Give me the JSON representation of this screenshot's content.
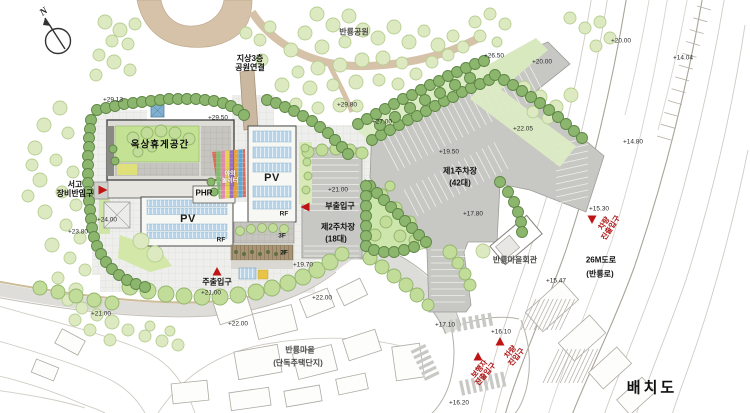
{
  "drawing_title": "배치도",
  "compass": {
    "label": "N"
  },
  "colors": {
    "marker_red": "#c01414",
    "lawn_green": "#cde6ab",
    "hedge_green": "#8cb66d",
    "parking_gray": "#c7c7c4",
    "pv_panel_blue": "#b7d3e7",
    "path_tan": "#d6c2a8"
  },
  "places": [
    {
      "id": "banryong-park",
      "text": "반룡공원",
      "x": 354,
      "y": 33,
      "cls": "place"
    },
    {
      "id": "park-connection",
      "text": "지상3층\n공원연결",
      "x": 250,
      "y": 64,
      "cls": "bold-k"
    },
    {
      "id": "rooftop-rest-space",
      "text": "옥상휴게공간",
      "x": 160,
      "y": 146,
      "cls": "bold-k big"
    },
    {
      "id": "outdoor-playground",
      "text": "야외\n놀이터",
      "x": 230,
      "y": 178,
      "cls": "white-k"
    },
    {
      "id": "phr",
      "text": "PHR",
      "x": 204,
      "y": 194,
      "cls": "bold-k"
    },
    {
      "id": "pv-upper",
      "text": "PV",
      "x": 272,
      "y": 178,
      "cls": "pv"
    },
    {
      "id": "rf-upper",
      "text": "RF",
      "x": 284,
      "y": 214,
      "cls": "rf"
    },
    {
      "id": "pv-lower",
      "text": "PV",
      "x": 188,
      "y": 219,
      "cls": "pv"
    },
    {
      "id": "rf-lower",
      "text": "RF",
      "x": 221,
      "y": 240,
      "cls": "rf"
    },
    {
      "id": "floor-3f",
      "text": "3F",
      "x": 282,
      "y": 236,
      "cls": "rf"
    },
    {
      "id": "floor-2f",
      "text": "2F",
      "x": 284,
      "y": 253,
      "cls": "rf"
    },
    {
      "id": "parking1-name",
      "text": "제1주차장",
      "x": 460,
      "y": 172,
      "cls": "bold-k"
    },
    {
      "id": "parking1-capacity",
      "text": "(42대)",
      "x": 460,
      "y": 184,
      "cls": "bold-k"
    },
    {
      "id": "parking2-name",
      "text": "제2주차장",
      "x": 338,
      "y": 228,
      "cls": "bold-k"
    },
    {
      "id": "parking2-capacity",
      "text": "(18대)",
      "x": 336,
      "y": 240,
      "cls": "bold-k"
    },
    {
      "id": "village-hall",
      "text": "반룡마을회관",
      "x": 515,
      "y": 261,
      "cls": "place"
    },
    {
      "id": "village",
      "text": "반룡마을",
      "x": 300,
      "y": 351,
      "cls": "place"
    },
    {
      "id": "village-sub",
      "text": "(단독주택단지)",
      "x": 298,
      "y": 364,
      "cls": "place"
    },
    {
      "id": "road-26m",
      "text": "26M도로",
      "x": 601,
      "y": 261,
      "cls": "bold-k"
    },
    {
      "id": "road-26m-sub",
      "text": "(반룡로)",
      "x": 600,
      "y": 275,
      "cls": "bold-k"
    }
  ],
  "entrances": [
    {
      "id": "storage-service-entrance",
      "text": "서고\n장비반입구",
      "x": 75,
      "y": 190,
      "cls": "bold-k",
      "marker": {
        "x": 102,
        "y": 190,
        "dir": "right"
      }
    },
    {
      "id": "sub-entrance",
      "text": "부출입구",
      "x": 340,
      "y": 207,
      "cls": "bold-k",
      "marker": {
        "x": 306,
        "y": 207,
        "dir": "left"
      }
    },
    {
      "id": "main-entrance",
      "text": "주출입구",
      "x": 217,
      "y": 283,
      "cls": "bold-k",
      "marker": {
        "x": 217,
        "y": 272,
        "dir": "up"
      }
    },
    {
      "id": "vehicle-exit-entrance",
      "text": "차량\n진출입구",
      "x": 608,
      "y": 226,
      "cls": "red-k",
      "rot": -57,
      "marker": {
        "x": 592,
        "y": 219,
        "dir": "down"
      }
    },
    {
      "id": "vehicle-entrance",
      "text": "차량\n진입구",
      "x": 514,
      "y": 355,
      "cls": "red-k",
      "rot": -50,
      "marker": {
        "x": 500,
        "y": 342,
        "dir": "up"
      }
    },
    {
      "id": "pedestrian-entrance",
      "text": "보행자\n진출입구",
      "x": 483,
      "y": 372,
      "cls": "red-k",
      "rot": -50,
      "marker": {
        "x": 478,
        "y": 357,
        "dir": "up"
      }
    }
  ],
  "elevations": [
    {
      "text": "+20.00",
      "x": 621,
      "y": 41
    },
    {
      "text": "+14.04",
      "x": 683,
      "y": 58
    },
    {
      "text": "+26.50",
      "x": 494,
      "y": 56
    },
    {
      "text": "+20.00",
      "x": 542,
      "y": 62
    },
    {
      "text": "+29.80",
      "x": 347,
      "y": 105
    },
    {
      "text": "+29.13",
      "x": 113,
      "y": 100
    },
    {
      "text": "+29.50",
      "x": 218,
      "y": 118
    },
    {
      "text": "+27.00",
      "x": 382,
      "y": 122
    },
    {
      "text": "+22.05",
      "x": 523,
      "y": 129
    },
    {
      "text": "+14.80",
      "x": 633,
      "y": 142
    },
    {
      "text": "+19.50",
      "x": 449,
      "y": 152
    },
    {
      "text": "+21.00",
      "x": 338,
      "y": 190
    },
    {
      "text": "+15.30",
      "x": 599,
      "y": 209
    },
    {
      "text": "+17.80",
      "x": 473,
      "y": 214
    },
    {
      "text": "+24.00",
      "x": 107,
      "y": 220
    },
    {
      "text": "+23.80",
      "x": 78,
      "y": 232
    },
    {
      "text": "+19.70",
      "x": 303,
      "y": 265
    },
    {
      "text": "+15.47",
      "x": 556,
      "y": 281
    },
    {
      "text": "+21.00",
      "x": 211,
      "y": 293
    },
    {
      "text": "+22.00",
      "x": 322,
      "y": 298
    },
    {
      "text": "+22.00",
      "x": 238,
      "y": 324
    },
    {
      "text": "+21.00",
      "x": 101,
      "y": 314
    },
    {
      "text": "+17.10",
      "x": 445,
      "y": 325
    },
    {
      "text": "+16.10",
      "x": 501,
      "y": 332
    },
    {
      "text": "+16.20",
      "x": 459,
      "y": 403
    }
  ]
}
